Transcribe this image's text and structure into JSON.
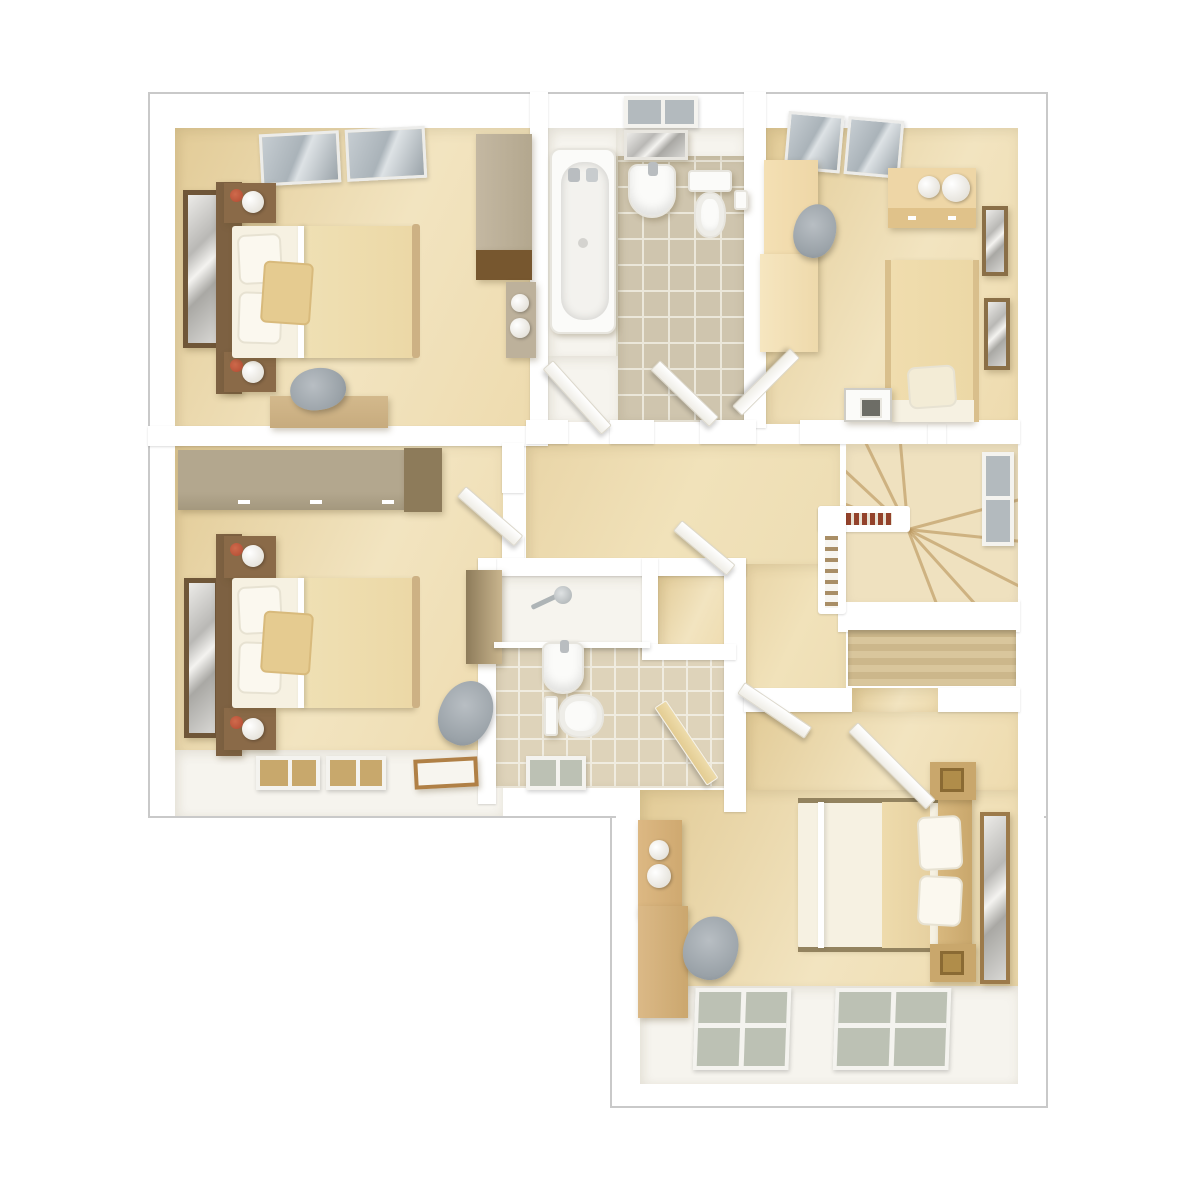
{
  "scene": {
    "kind": "3d-floor-plan-render",
    "view": "top-down dollhouse",
    "rooms": [
      {
        "id": "bedroom-top-left",
        "contents": [
          "double-bed",
          "headboard",
          "nightstand-with-lamp",
          "nightstand-with-lamp",
          "wall-mirror",
          "desk",
          "desk-chair",
          "wardrobe",
          "shelf-unit",
          "skylight-window"
        ]
      },
      {
        "id": "bathroom-top",
        "contents": [
          "bathtub",
          "pedestal-basin",
          "mirror",
          "toilet",
          "toilet-roll-holder",
          "window",
          "tiled-floor",
          "door",
          "door"
        ]
      },
      {
        "id": "bedroom-top-right",
        "contents": [
          "single-bed",
          "pillow",
          "chest-of-drawers",
          "decor-bowls",
          "desk",
          "desk-chair",
          "wardrobe",
          "picture-frame",
          "picture-frame",
          "nightstand",
          "skylight-window"
        ]
      },
      {
        "id": "bedroom-mid-left",
        "contents": [
          "double-bed",
          "headboard",
          "nightstand-with-lamp",
          "nightstand-with-lamp",
          "wall-mirror",
          "long-wardrobe",
          "desk",
          "desk-chair",
          "window",
          "window",
          "floor-tray"
        ]
      },
      {
        "id": "landing",
        "contents": [
          "winder-staircase",
          "balustrade",
          "stair-window",
          "storage-nook",
          "door",
          "door",
          "door",
          "door"
        ]
      },
      {
        "id": "en-suite",
        "contents": [
          "shower",
          "basin",
          "toilet",
          "window",
          "tiled-floor",
          "door"
        ]
      },
      {
        "id": "master-bedroom",
        "contents": [
          "double-bed",
          "headboard",
          "pillows",
          "nightstand",
          "nightstand",
          "wall-mirror",
          "tall-cabinet",
          "dressing-table",
          "chair",
          "built-in-wardrobe",
          "window",
          "window",
          "door"
        ]
      }
    ]
  },
  "colors": {
    "wall-white": "#ffffff",
    "shell-line": "#c9c9c9",
    "floor-beige": "#eedbae",
    "floor-beige-dark": "#e2cb97",
    "floor-beige-light": "#f2e4c0",
    "landing-beige": "#f1e2ba",
    "pale-floor": "#f6f4ee",
    "tile-taupe": "#cfc5ae",
    "tile-grout": "#ebe7da",
    "ens-tile": "#ded3ba",
    "ens-grout": "#f0ece0",
    "glass-blue": "#b3babe",
    "glass-green": "#bcc1b4",
    "glass-tan": "#c8a86c",
    "wood-dark": "#7d6142",
    "wood-brown": "#8a6a48",
    "wood-mid": "#c9a76c",
    "wood-tan": "#d3b98c",
    "wood-cream": "#eed6a6",
    "duvet-cream": "#ecd8a6",
    "sheet-white": "#f6f1e2",
    "wardrobe-grey": "#b3a78e",
    "wardrobe-grey-dark": "#8d7b5a",
    "chair-grey": "#9aa2a8",
    "lamp-red": "#b04a31",
    "stairs-bg": "#efe1bf",
    "stairs-line": "#bb985f",
    "rail-wood": "#93422b",
    "planks-light": "#d9c69c",
    "planks-dark": "#ccb78b",
    "white-fixture": "#fbfbf9"
  }
}
